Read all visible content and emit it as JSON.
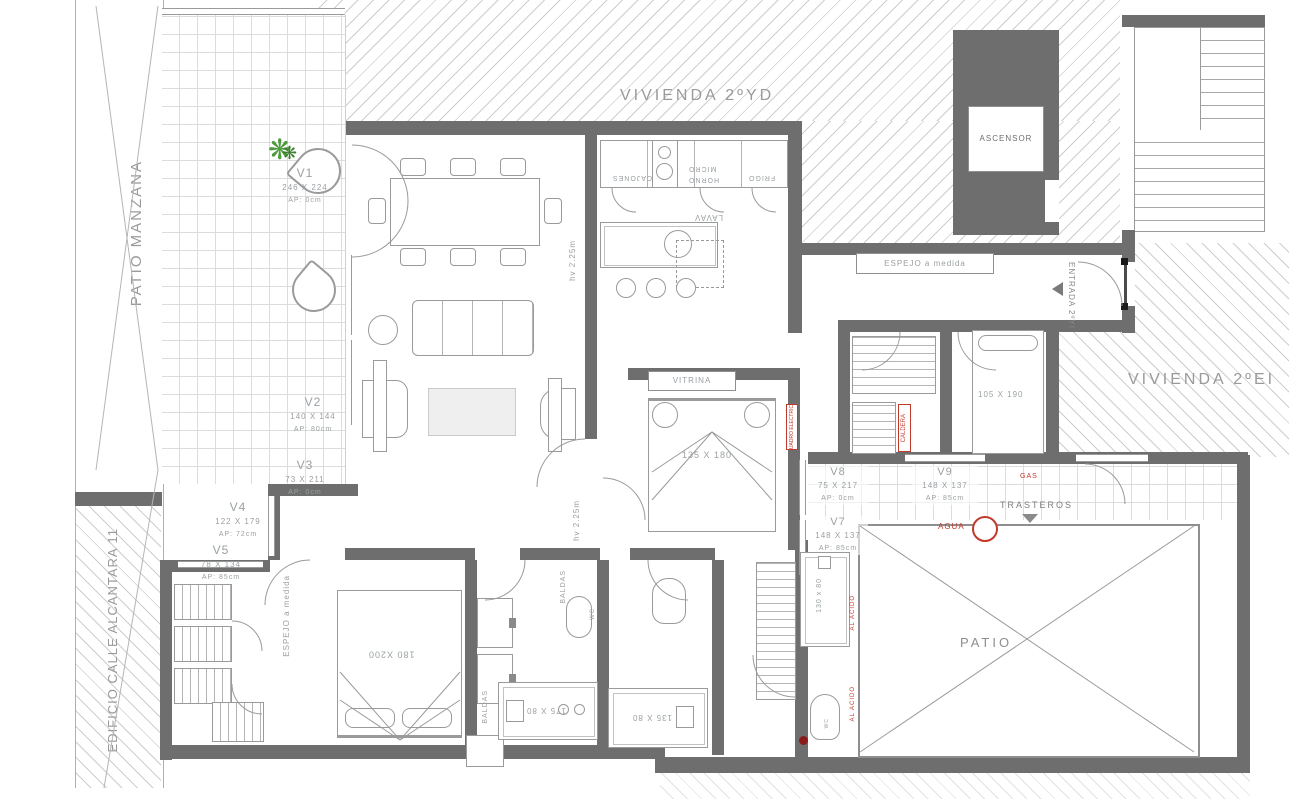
{
  "regions": {
    "vivienda_yd": "VIVIENDA 2ºYD",
    "vivienda_ei": "VIVIENDA 2ºEI",
    "patio_manzana": "PATIO MANZANA",
    "edificio_calle": "EDIFICIO CALLE ALCANTARA 11",
    "patio": "PATIO",
    "entrada": "ENTRADA 2ºYI"
  },
  "core": {
    "ascensor": "ASCENSOR",
    "trasteros": "TRASTEROS",
    "montacargas": "MONTACARGAS"
  },
  "windows": [
    {
      "id": "V1",
      "dim": "246 X 224",
      "ap": "AP: 0cm"
    },
    {
      "id": "V2",
      "dim": "140 X 144",
      "ap": "AP: 80cm"
    },
    {
      "id": "V3",
      "dim": "73 X 211",
      "ap": "AP: 0cm"
    },
    {
      "id": "V4",
      "dim": "122 X 179",
      "ap": "AP: 72cm"
    },
    {
      "id": "V5",
      "dim": "78 X 134",
      "ap": "AP: 85cm"
    },
    {
      "id": "V7",
      "dim": "148 X 137",
      "ap": "AP: 85cm"
    },
    {
      "id": "V8",
      "dim": "75 X 217",
      "ap": "AP: 0cm"
    },
    {
      "id": "V9",
      "dim": "148 X 137",
      "ap": "AP: 85cm"
    }
  ],
  "furniture": {
    "vitrina": "VITRINA",
    "espejo_hall": "ESPEJO a medida",
    "espejo_master": "ESPEJO a medida",
    "bed_master": "180 X200",
    "bed_center": "135 X 180",
    "bed_right": "105 X 190",
    "shower_bath1": "175 X 80",
    "shower_bath2": "135 X 80",
    "shower_bath3": "130 x 80",
    "baldas_1": "BALDAS",
    "baldas_2": "BALDAS",
    "wc_1": "WC",
    "wc_2": "WC"
  },
  "kitchen": {
    "frigo": "FRIGO",
    "horno": "HORNO",
    "micro": "MICRO",
    "cajones": "CAJONES",
    "lavav": "LAVAV"
  },
  "annotations": {
    "hv_1": "hv 2.25m",
    "hv_2": "hv 2.25m"
  },
  "utilities": {
    "agua": "AGUA",
    "gas": "GAS",
    "al_acido_1": "AL ACIDO",
    "al_acido_2": "AL ACIDO",
    "caldera": "CALDERA",
    "cuadro_electrico": "CUADRO ELECTRICO"
  },
  "colors": {
    "wall": "#6e6e6e",
    "line": "#9a9a9a",
    "label": "#9aa0a3",
    "red": "#c0392b",
    "plant": "#4e9a3c"
  }
}
